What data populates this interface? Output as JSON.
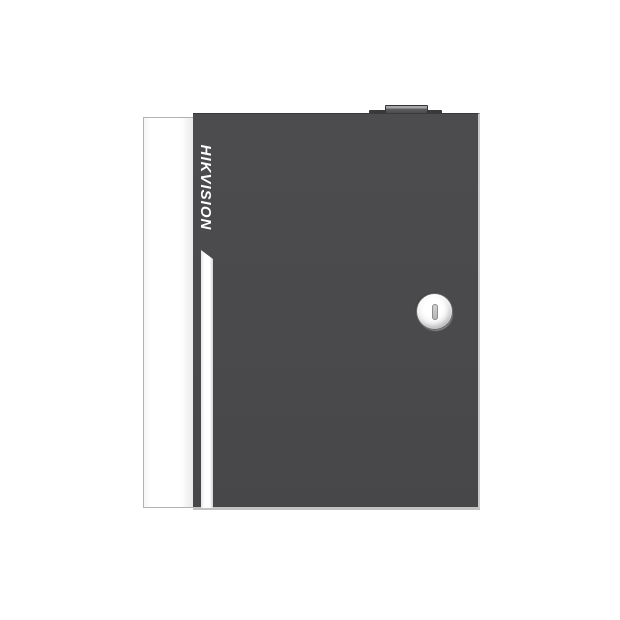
{
  "page": {
    "background": "#ffffff",
    "description_label": ""
  },
  "device": {
    "brand_label": "HIKVISION",
    "colors": {
      "page_bg": "#ffffff",
      "door": "#4a4a4c",
      "side_panel": "#ffffff",
      "accent_stripe": "#ffffff",
      "edge_highlight": "#c9c9c9",
      "brand_text": "#ffffff",
      "lock_face": "#ffffff",
      "top_base": "#39393b",
      "top_block_highlight": "#a5a5a7"
    }
  }
}
